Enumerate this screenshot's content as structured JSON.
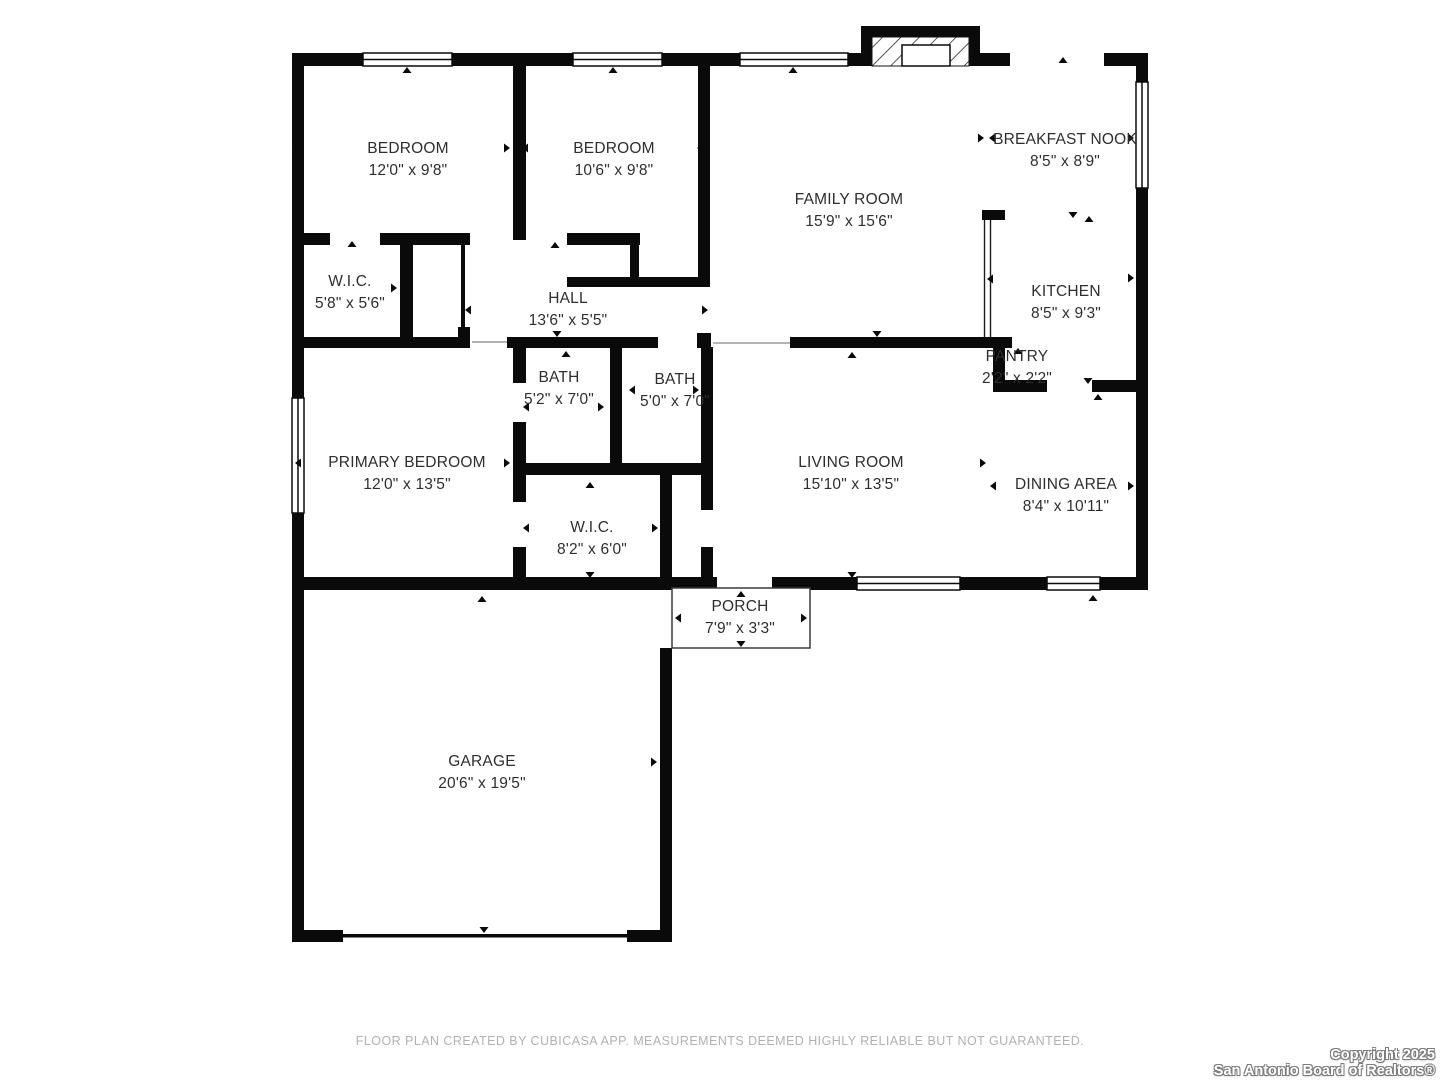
{
  "rooms": {
    "bedroom1": {
      "name": "BEDROOM",
      "dims": "12'0\" x 9'8\""
    },
    "bedroom2": {
      "name": "BEDROOM",
      "dims": "10'6\" x 9'8\""
    },
    "family_room": {
      "name": "FAMILY ROOM",
      "dims": "15'9\" x 15'6\""
    },
    "breakfast_nook": {
      "name": "BREAKFAST NOOK",
      "dims": "8'5\" x 8'9\""
    },
    "kitchen": {
      "name": "KITCHEN",
      "dims": "8'5\" x 9'3\""
    },
    "wic1": {
      "name": "W.I.C.",
      "dims": "5'8\" x 5'6\""
    },
    "hall": {
      "name": "HALL",
      "dims": "13'6\" x 5'5\""
    },
    "pantry": {
      "name": "PANTRY",
      "dims": "2'2\" x 2'2\""
    },
    "bath1": {
      "name": "BATH",
      "dims": "5'2\" x 7'0\""
    },
    "bath2": {
      "name": "BATH",
      "dims": "5'0\" x 7'0\""
    },
    "primary_bedroom": {
      "name": "PRIMARY BEDROOM",
      "dims": "12'0\" x 13'5\""
    },
    "living_room": {
      "name": "LIVING ROOM",
      "dims": "15'10\" x 13'5\""
    },
    "dining_area": {
      "name": "DINING AREA",
      "dims": "8'4\" x 10'11\""
    },
    "wic2": {
      "name": "W.I.C.",
      "dims": "8'2\" x 6'0\""
    },
    "porch": {
      "name": "PORCH",
      "dims": "7'9\" x 3'3\""
    },
    "garage": {
      "name": "GARAGE",
      "dims": "20'6\" x 19'5\""
    }
  },
  "footer": {
    "disclaimer": "FLOOR PLAN CREATED BY CUBICASA APP. MEASUREMENTS DEEMED HIGHLY RELIABLE BUT NOT GUARANTEED."
  },
  "copyright": {
    "line1": "Copyright 2025",
    "line2": "San Antonio Board of Realtors®"
  },
  "colors": {
    "wall": "#0a0a0a",
    "label_text": "#2e2e2e",
    "footer_text": "#b1b1b1",
    "copyright_fill": "#ffffff",
    "copyright_outline": "#7d7d7d",
    "background": "#ffffff"
  }
}
